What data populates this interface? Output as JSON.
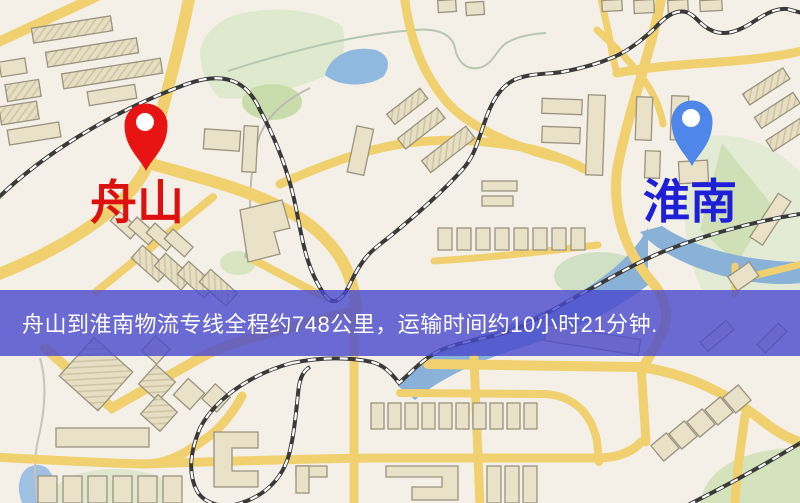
{
  "banner": {
    "text": "舟山到淮南物流专线全程约748公里，运输时间约10小时21分钟.",
    "background": "rgba(73,73,205,0.8)",
    "text_color": "#ffffff"
  },
  "markers": {
    "origin": {
      "label": "舟山",
      "icon": "red-map-pin-icon",
      "pin_color": "#e81414",
      "label_color": "#dd0f0f"
    },
    "destination": {
      "label": "淮南",
      "icon": "blue-map-pin-icon",
      "pin_color": "#4e86ea",
      "label_color": "#1f1fd8"
    }
  },
  "map": {
    "theme": {
      "background": "#f4f0e7",
      "road": "#f1d06f",
      "building_fill": "#e9e1c8",
      "building_stroke": "#99937f",
      "park_green": "#dfe9ce",
      "water_blue": "#8fb9de",
      "railway": "#3a3a3a"
    }
  }
}
